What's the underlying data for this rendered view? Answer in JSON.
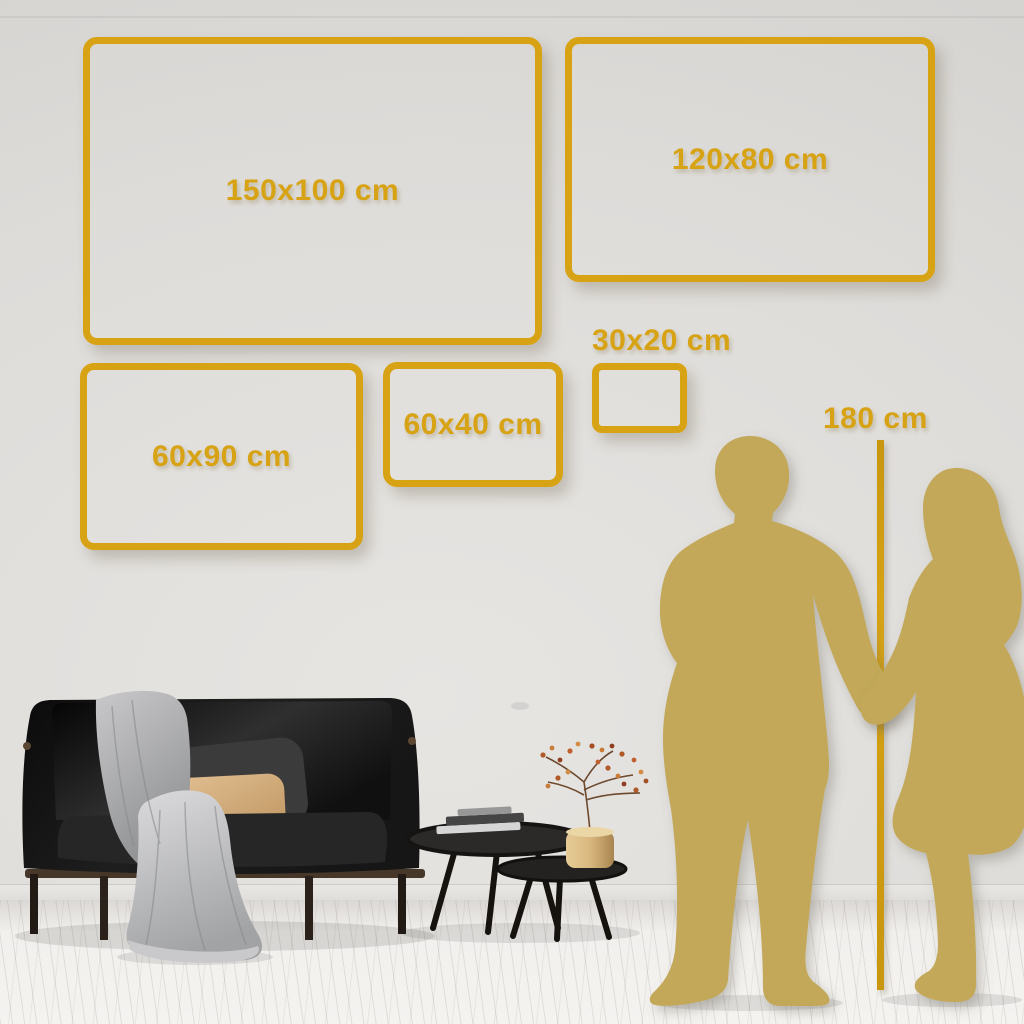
{
  "size_guide": {
    "boxes": [
      {
        "id": "150x100",
        "label": "150x100 cm"
      },
      {
        "id": "120x80",
        "label": "120x80 cm"
      },
      {
        "id": "60x90",
        "label": "60x90 cm"
      },
      {
        "id": "60x40",
        "label": "60x40 cm"
      },
      {
        "id": "30x20",
        "label": "30x20 cm"
      }
    ],
    "height_marker": {
      "label": "180 cm"
    }
  },
  "scene_objects": [
    "man-silhouette",
    "woman-silhouette",
    "height-ruler-line",
    "sofa",
    "throw-blanket",
    "pillows",
    "coffee-tables",
    "books",
    "vase-plant"
  ],
  "icons": {
    "man-silhouette": "svg-shape",
    "woman-silhouette": "svg-shape",
    "height-ruler-line": "css-rect"
  },
  "colors": {
    "gold": "#D7A314",
    "gold_deep": "#C8960F",
    "silhouette_gold": "#C2A858",
    "wall": "#DEDCD9",
    "floor": "#F2F0ED",
    "sofa_black": "#1A1A1A",
    "pillow_tan": "#D3AC79",
    "blanket_gray": "#B9BABC"
  }
}
